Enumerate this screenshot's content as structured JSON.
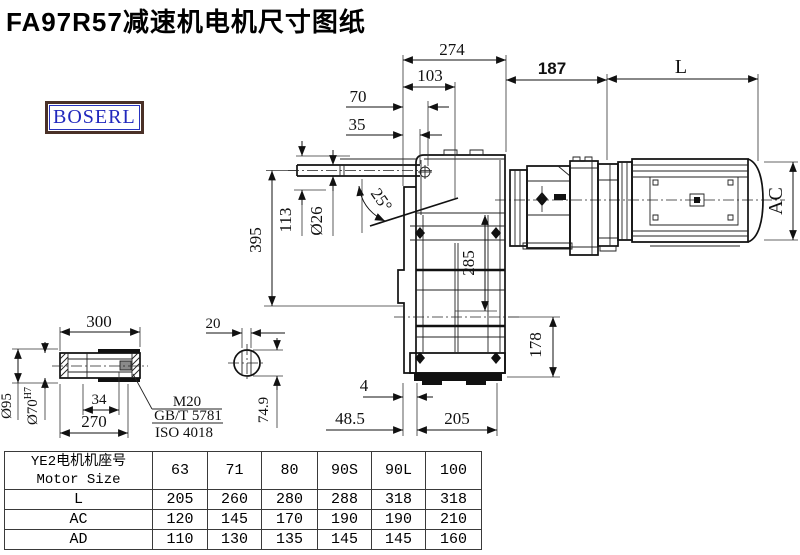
{
  "page": {
    "title": "FA97R57减速机电机尺寸图纸",
    "brand": "BOSERL"
  },
  "drawing": {
    "dims": {
      "overall_274": "274",
      "offset_103": "103",
      "offset_70": "70",
      "offset_35": "35",
      "motor_offset_187": "187",
      "motor_length_L": "L",
      "motor_diameter_AC": "AC",
      "height_395": "395",
      "height_113": "113",
      "shaft_dia_26": "Ø26",
      "angle_25": "25°",
      "bolt_span_285": "285",
      "axis_height_178": "178",
      "foot_4": "4",
      "foot_48_5": "48.5",
      "base_205": "205"
    },
    "shaft_detail": {
      "length_300": "300",
      "length_270": "270",
      "length_34": "34",
      "dia_95": "Ø95",
      "dia_70": "Ø70",
      "dia_70_tol": "H7",
      "thread": "M20",
      "standard_1": "GB/T 5781",
      "standard_2": "ISO 4018",
      "key_20": "20",
      "key_74_9": "74.9"
    }
  },
  "table": {
    "header_cn": "YE2电机机座号",
    "header_en": "Motor Size",
    "sizes": [
      "63",
      "71",
      "80",
      "90S",
      "90L",
      "100"
    ],
    "rows": [
      {
        "label": "L",
        "values": [
          "205",
          "260",
          "280",
          "288",
          "318",
          "318"
        ]
      },
      {
        "label": "AC",
        "values": [
          "120",
          "145",
          "170",
          "190",
          "190",
          "210"
        ]
      },
      {
        "label": "AD",
        "values": [
          "110",
          "130",
          "135",
          "145",
          "145",
          "160"
        ]
      }
    ]
  }
}
